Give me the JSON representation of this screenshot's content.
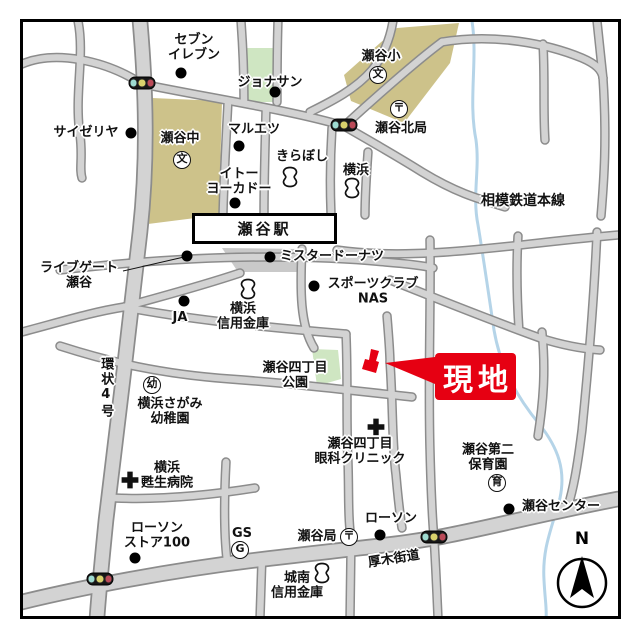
{
  "colors": {
    "road_fill": "#d3d3d3",
    "road_edge": "#8c8c8c",
    "railway": "#111111",
    "river": "#b5d4e8",
    "block_school": "#cdc28a",
    "block_park": "#cfe6c2",
    "block_plaza": "#c9c9c9",
    "site_red": "#e60012",
    "signal_green": "#9edbd1",
    "signal_yellow": "#d9d26c",
    "signal_red": "#bb4a58"
  },
  "symbols": {
    "school": "文",
    "post": "〒",
    "kinder": "幼",
    "nursery": "育",
    "gas": "G"
  },
  "railway": {
    "line_label": "相模鉄道本線",
    "station_label": "瀬谷駅"
  },
  "site": {
    "label": "現地"
  },
  "compass": {
    "label": "N"
  },
  "streets": [
    {
      "id": "kanjo-4",
      "label": "環状4号",
      "x": 105,
      "y": 388,
      "vertical": true
    },
    {
      "id": "atsugi-kaido",
      "label": "厚木街道",
      "x": 394,
      "y": 560,
      "rotate": -9
    }
  ],
  "pois": [
    {
      "id": "seven-eleven",
      "label": "セブン\nイレブン",
      "marker": "dot",
      "mx": 181,
      "my": 73,
      "lx": 194,
      "ly": 48
    },
    {
      "id": "jonathan",
      "label": "ジョナサン",
      "marker": "dot",
      "mx": 275,
      "my": 92,
      "lx": 270,
      "ly": 83
    },
    {
      "id": "saizeriya",
      "label": "サイゼリヤ",
      "marker": "dot",
      "mx": 131,
      "my": 133,
      "lx": 86,
      "ly": 133
    },
    {
      "id": "seya-junior-high",
      "label": "瀬谷中",
      "marker": "school",
      "mx": 182,
      "my": 160,
      "lx": 180,
      "ly": 139
    },
    {
      "id": "maruetsu",
      "label": "マルエツ",
      "marker": "dot",
      "mx": 239,
      "my": 146,
      "lx": 254,
      "ly": 130
    },
    {
      "id": "seya-elementary",
      "label": "瀬谷小",
      "marker": "school",
      "mx": 378,
      "my": 75,
      "lx": 381,
      "ly": 57
    },
    {
      "id": "seya-kita-post-office",
      "label": "瀬谷北局",
      "marker": "post",
      "mx": 399,
      "my": 109,
      "lx": 401,
      "ly": 129
    },
    {
      "id": "kiraboshi-bank",
      "label": "きらぼし",
      "marker": "bank",
      "mx": 290,
      "my": 177,
      "lx": 302,
      "ly": 157
    },
    {
      "id": "yokohama-bank",
      "label": "横浜",
      "marker": "bank",
      "mx": 352,
      "my": 188,
      "lx": 356,
      "ly": 171
    },
    {
      "id": "ito-yokado",
      "label": "イトー\nヨーカドー",
      "marker": "dot",
      "mx": 235,
      "my": 203,
      "lx": 239,
      "ly": 182
    },
    {
      "id": "livegate-seya",
      "label": "ライブゲート\n瀬谷",
      "marker": "dot",
      "mx": 187,
      "my": 256,
      "lx": 79,
      "ly": 276,
      "callout": [
        123,
        271,
        184,
        257
      ]
    },
    {
      "id": "mister-donut",
      "label": "ミスタードーナツ",
      "marker": "dot",
      "mx": 270,
      "my": 257,
      "lx": 332,
      "ly": 257
    },
    {
      "id": "sports-club-nas",
      "label": "スポーツクラブ\nNAS",
      "marker": "dot",
      "mx": 314,
      "my": 286,
      "lx": 373,
      "ly": 292
    },
    {
      "id": "ja",
      "label": "JA",
      "marker": "dot",
      "mx": 184,
      "my": 301,
      "lx": 180,
      "ly": 318
    },
    {
      "id": "yokohama-shinkin-bank",
      "label": "横浜\n信用金庫",
      "marker": "bank",
      "mx": 248,
      "my": 289,
      "lx": 243,
      "ly": 317
    },
    {
      "id": "seya-4chome-park",
      "label": "瀬谷四丁目\n公園",
      "marker": "none",
      "lx": 295,
      "ly": 376
    },
    {
      "id": "yokohama-sagami-kindergarten",
      "label": "横浜さがみ\n幼稚園",
      "marker": "kinder",
      "mx": 152,
      "my": 385,
      "lx": 170,
      "ly": 412
    },
    {
      "id": "seya-4chome-eye-clinic",
      "label": "瀬谷四丁目\n眼科クリニック",
      "marker": "hospital",
      "mx": 376,
      "my": 427,
      "lx": 360,
      "ly": 452
    },
    {
      "id": "yokohama-sosei-hospital",
      "label": "横浜\n甦生病院",
      "marker": "hospital",
      "mx": 130,
      "my": 480,
      "lx": 167,
      "ly": 476
    },
    {
      "id": "seya-daini-nursery",
      "label": "瀬谷第二\n保育園",
      "marker": "nursery",
      "mx": 497,
      "my": 483,
      "lx": 488,
      "ly": 458
    },
    {
      "id": "lawson-store-100",
      "label": "ローソン\nストア100",
      "marker": "dot",
      "mx": 135,
      "my": 558,
      "lx": 157,
      "ly": 536
    },
    {
      "id": "gas-station",
      "label": "GS",
      "marker": "gas",
      "mx": 240,
      "my": 550,
      "lx": 242,
      "ly": 534
    },
    {
      "id": "seya-post-office",
      "label": "瀬谷局",
      "marker": "post",
      "mx": 349,
      "my": 537,
      "lx": 317,
      "ly": 537
    },
    {
      "id": "lawson",
      "label": "ローソン",
      "marker": "dot",
      "mx": 380,
      "my": 535,
      "lx": 391,
      "ly": 519
    },
    {
      "id": "seya-center",
      "label": "瀬谷センター",
      "marker": "dot",
      "mx": 509,
      "my": 509,
      "lx": 561,
      "ly": 507
    },
    {
      "id": "jonan-shinkin-bank",
      "label": "城南\n信用金庫",
      "marker": "bank",
      "mx": 322,
      "my": 573,
      "lx": 297,
      "ly": 586
    },
    {
      "id": "signal-northwest",
      "label": "",
      "marker": "signal",
      "mx": 142,
      "my": 83
    },
    {
      "id": "signal-seya-kita",
      "label": "",
      "marker": "signal",
      "mx": 344,
      "my": 125
    },
    {
      "id": "signal-atsugi-kaido",
      "label": "",
      "marker": "signal",
      "mx": 434,
      "my": 537
    },
    {
      "id": "signal-southwest",
      "label": "",
      "marker": "signal",
      "mx": 100,
      "my": 579
    }
  ]
}
